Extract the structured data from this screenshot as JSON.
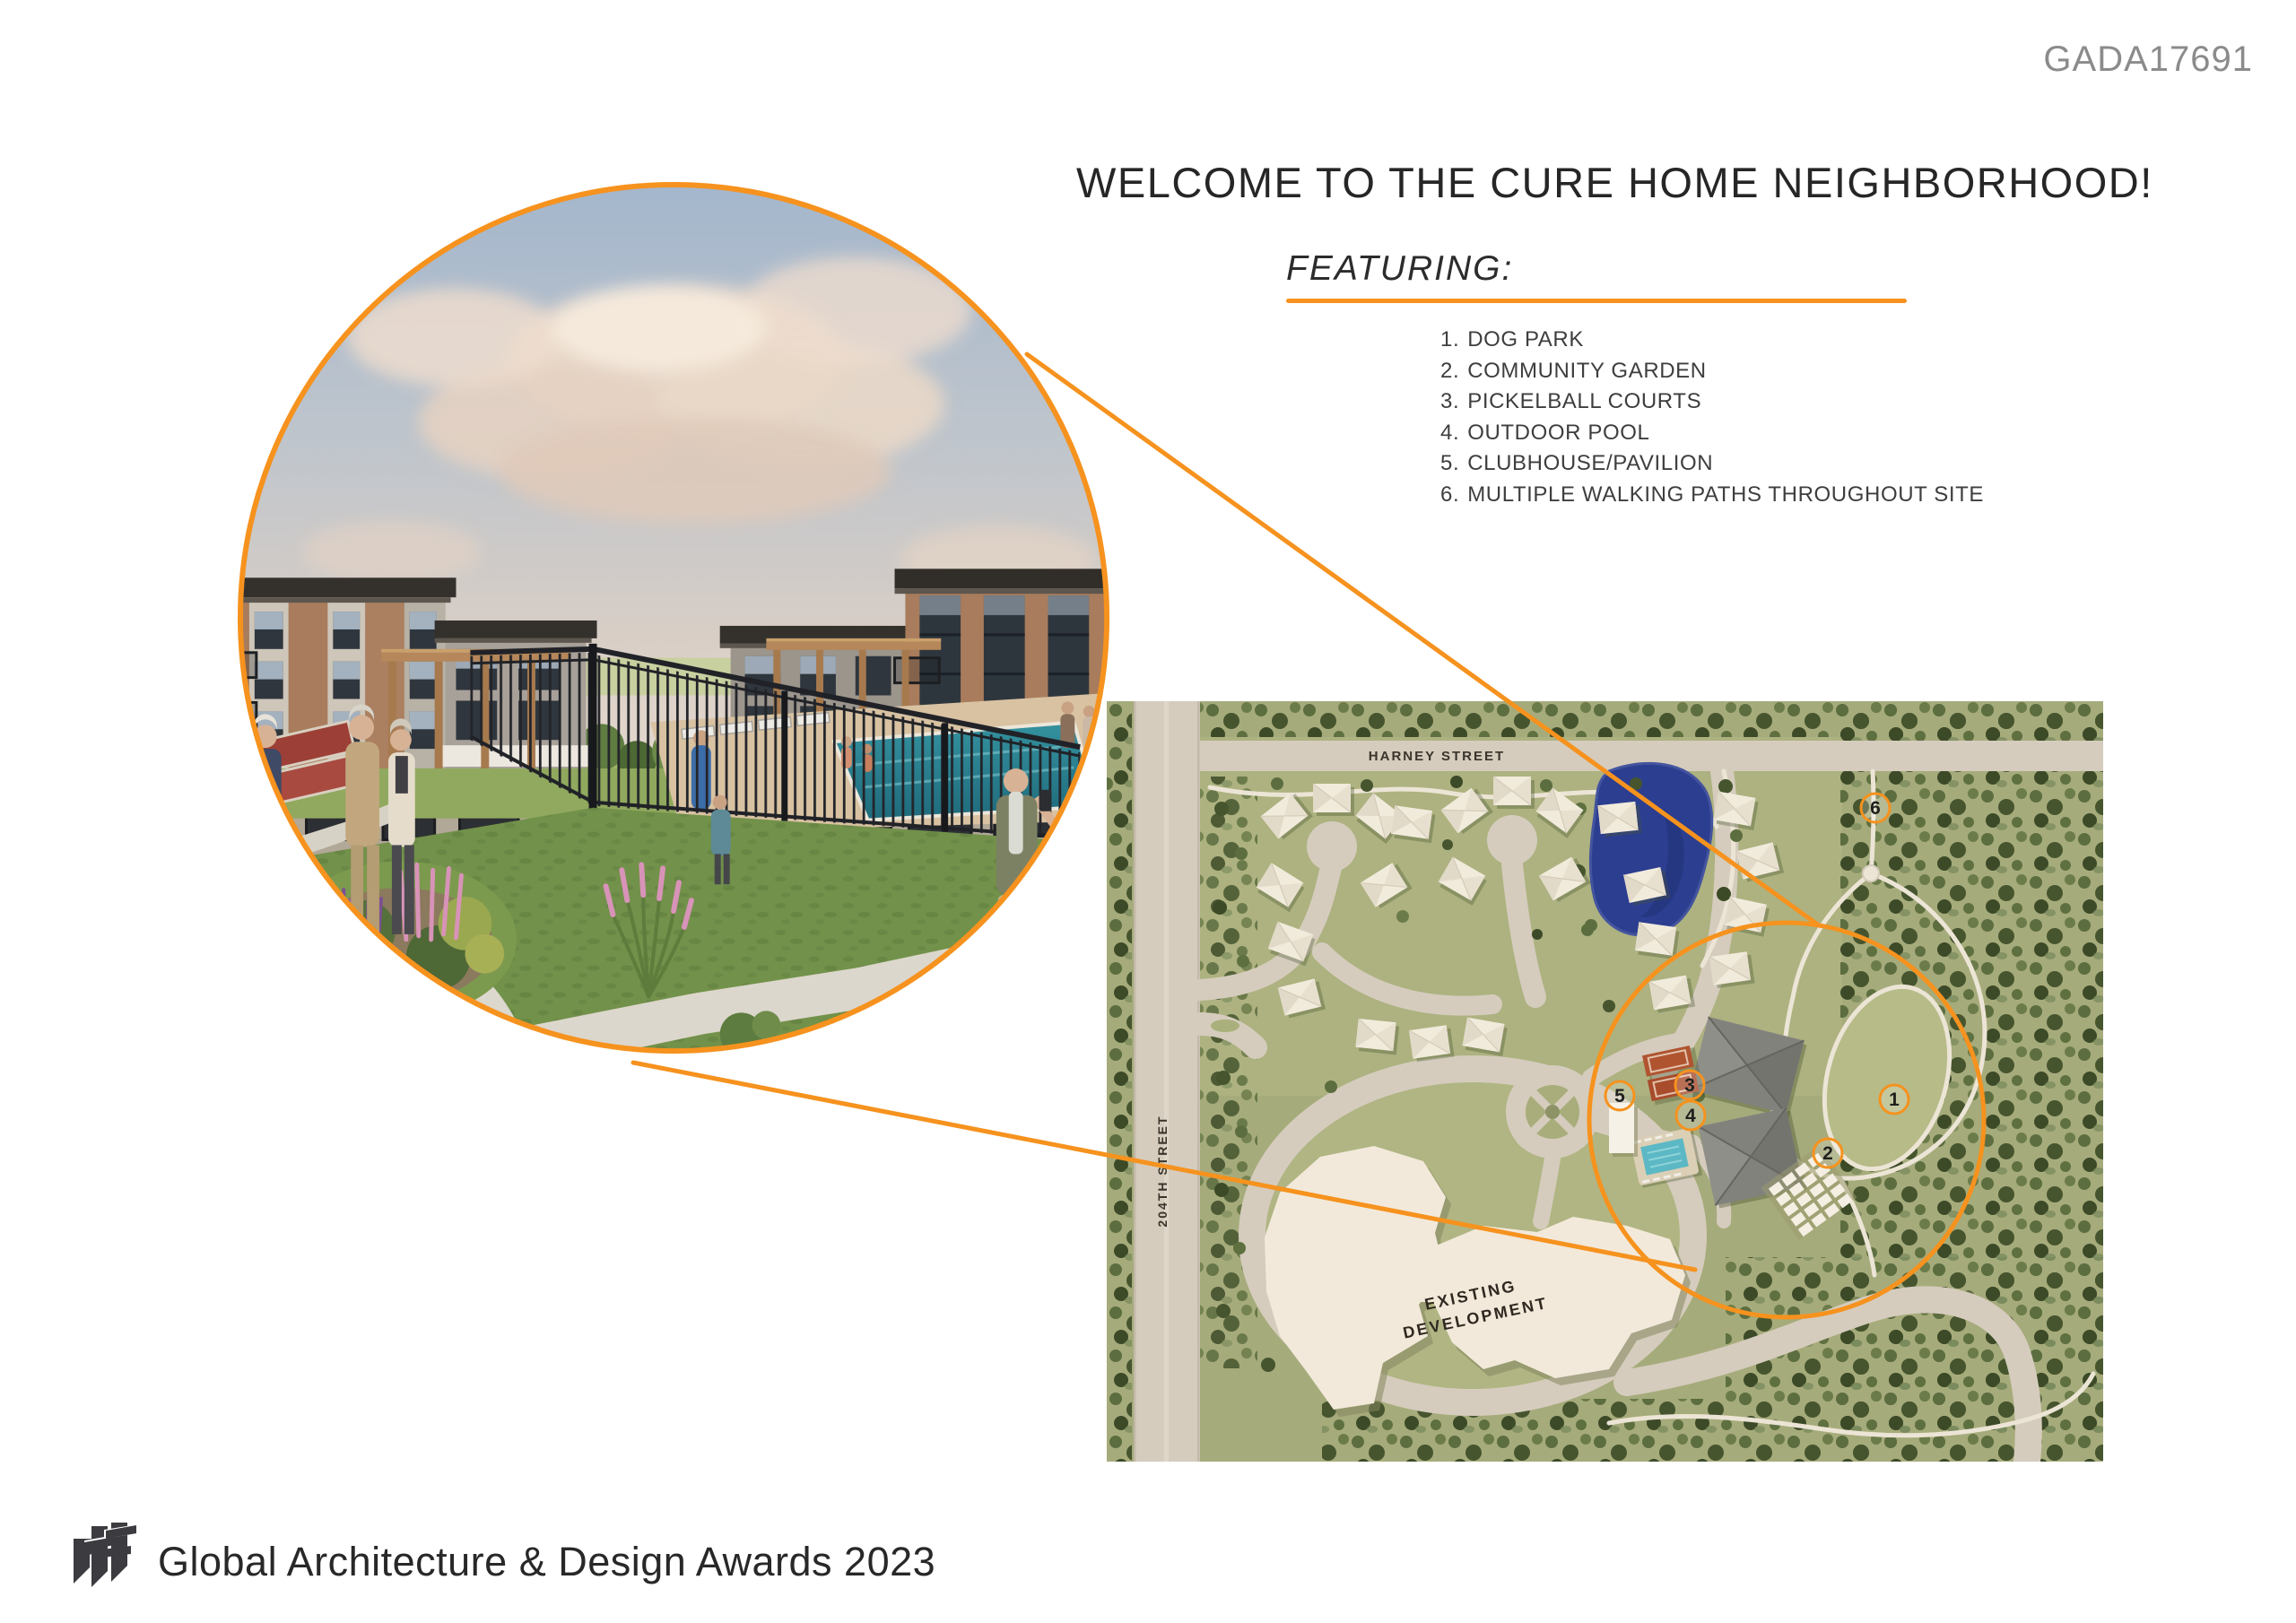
{
  "header": {
    "code": "GADA17691"
  },
  "content": {
    "title": "WELCOME TO THE CURE HOME NEIGHBORHOOD!",
    "featuring_label": "FEATURING:",
    "features": [
      {
        "num": "1.",
        "label": "DOG PARK"
      },
      {
        "num": "2.",
        "label": "COMMUNITY GARDEN"
      },
      {
        "num": "3.",
        "label": "PICKELBALL COURTS"
      },
      {
        "num": "4.",
        "label": "OUTDOOR POOL"
      },
      {
        "num": "5.",
        "label": "CLUBHOUSE/PAVILION"
      },
      {
        "num": "6.",
        "label": "MULTIPLE WALKING PATHS THROUGHOUT SITE"
      }
    ]
  },
  "siteplan": {
    "harney_street": "HARNEY STREET",
    "street_204": "204TH STREET",
    "existing_line1": "EXISTING",
    "existing_line2": "DEVELOPMENT",
    "markers": [
      {
        "num": "1"
      },
      {
        "num": "2"
      },
      {
        "num": "3"
      },
      {
        "num": "4"
      },
      {
        "num": "5"
      },
      {
        "num": "6"
      }
    ]
  },
  "footer": {
    "logo": "rtf",
    "text": "Global Architecture & Design Awards 2023"
  },
  "colors": {
    "accent": "#F6921E"
  }
}
